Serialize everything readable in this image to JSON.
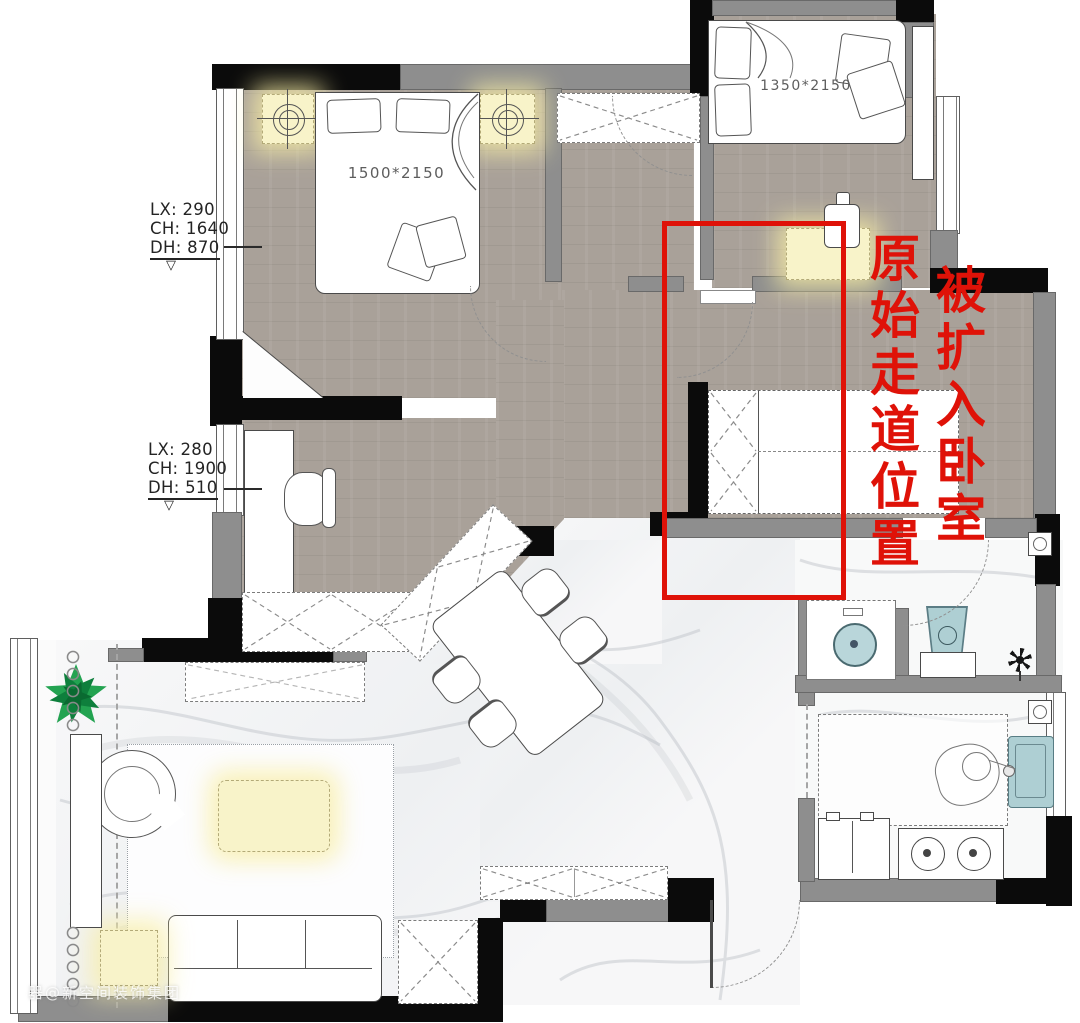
{
  "annotations": {
    "column1": "原始走道位置",
    "column2": "被扩入卧室"
  },
  "dimensions": {
    "label1": {
      "lx": "LX: 290",
      "ch": "CH: 1640",
      "dh": "DH: 870"
    },
    "label2": {
      "lx": "LX: 280",
      "ch": "CH: 1900",
      "dh": "DH: 510"
    },
    "datum": "▽"
  },
  "beds": {
    "master": "1500*2150",
    "second": "1350*2150"
  },
  "watermark": "器@新空间装饰集团",
  "palette": {
    "annotation_red": "#df1208",
    "wood_floor": "#a9a199",
    "wall_gray": "#8e8e8e",
    "wall_black": "#0b0b0b",
    "fixture_teal": "#aecfd3",
    "light_glow_yellow": "#f8f3c9",
    "plant_green": "#1f9b4d",
    "marble_white": "#f6f6f7"
  }
}
